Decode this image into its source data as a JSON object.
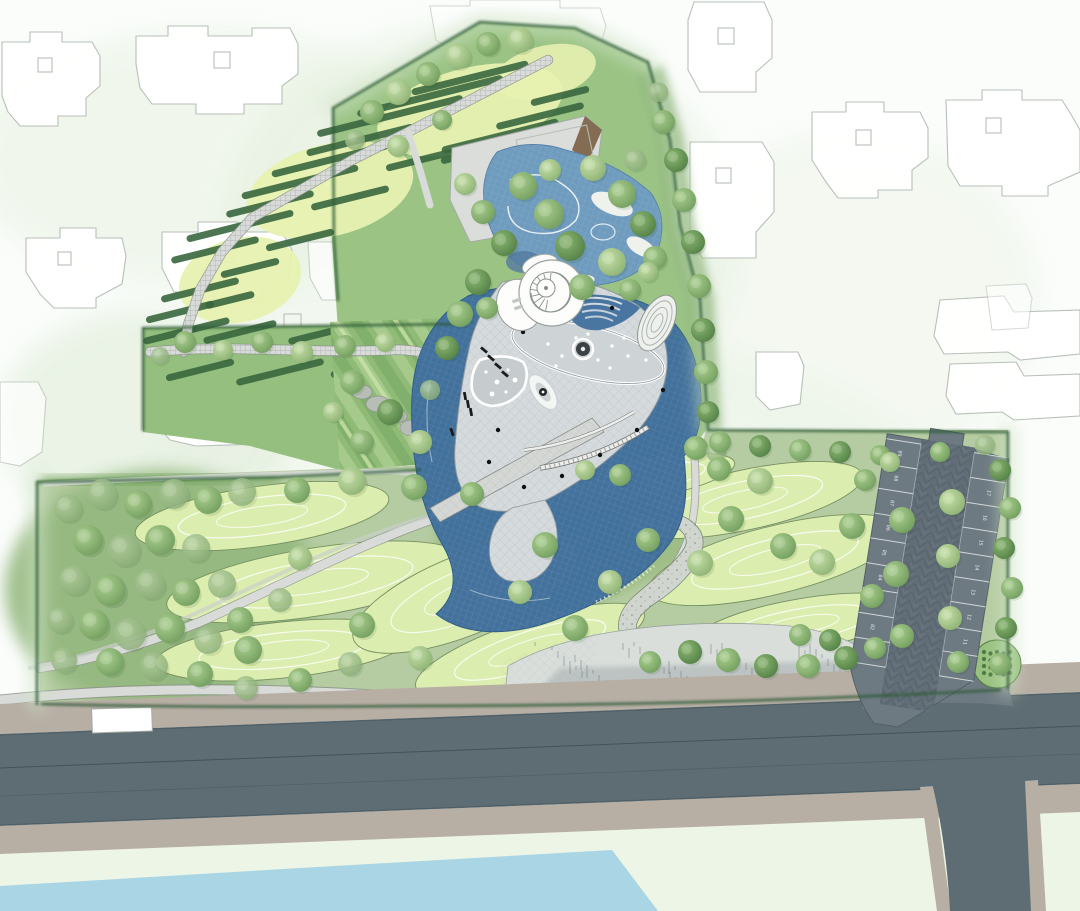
{
  "plan": {
    "kind": "landscape-master-plan",
    "visible_text_note": "only small rotated parking stall numbers are legible"
  },
  "colors": {
    "background": "#fbfdfb",
    "building_outline": "#b9bfba",
    "park_green": "#9ac384",
    "park_green_dark": "#74a35e",
    "corridor_green": "#94bf7e",
    "lower_park_green": "#b5cba1",
    "dense_trees_green": "#93b77e",
    "hedge_dark": "#2e5b38",
    "lawn_pale": "#e7f1b0",
    "mound_fill": "#dcedb0",
    "mound_outline": "#76905f",
    "contour_white": "#ffffff",
    "path_fill": "#d8dbd8",
    "path_casing": "#8a8f8a",
    "plaza_fill": "#d5dadc",
    "plaza_grid": "#b6bec2",
    "water_deep": "#41709d",
    "water_light": "#6f9cbe",
    "sand": "#eef1ec",
    "roof_gray": "#daddda",
    "roof_brown": "#7a5f44",
    "road_asphalt": "#5d6d73",
    "sidewalk_tan": "#b7aea4",
    "parking_asphalt": "#6d7a82",
    "stall_line": "#e3e7e8",
    "bottom_water": "#a9d5e4",
    "bottom_field": "#ecf5e6"
  },
  "parking": {
    "left_stalls_top_to_bottom": [
      "09",
      "08",
      "07",
      "06",
      "05",
      "04",
      "03",
      "02",
      "01"
    ],
    "right_stalls_top_to_bottom": [
      "18",
      "17",
      "16",
      "15",
      "14",
      "13",
      "12",
      "11",
      "10"
    ]
  }
}
